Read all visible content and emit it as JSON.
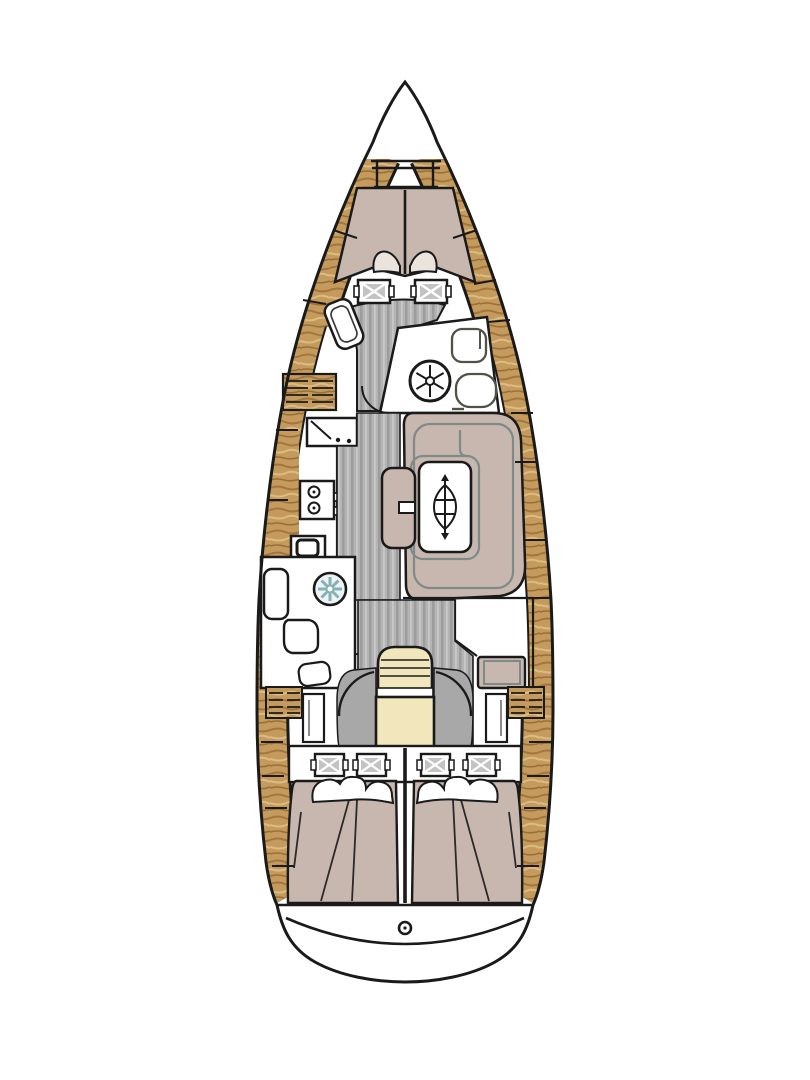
{
  "diagram": {
    "type": "sailboat-interior-floor-plan",
    "view": "top-down, bow at top / stern at bottom",
    "areas": [
      "anchor-locker",
      "v-berth-forward-cabin",
      "forward-cabin-seat",
      "forward-head-bathroom",
      "galley",
      "saloon-dinette",
      "saloon-table",
      "centerline-bench",
      "aft-head-bathroom",
      "chart-table-nav-station",
      "companionway-steps",
      "aft-cabin-port",
      "aft-cabin-starboard",
      "stern-swim-platform"
    ],
    "fixtures": [
      "windlass-frame",
      "berth-pillows",
      "hatch-seat-cushions",
      "sink-forward",
      "toilet-forward",
      "basin-forward",
      "fridge-top-load",
      "two-burner-stove",
      "oven",
      "sink-aft-teal",
      "toilet-aft",
      "table-extension-symbol",
      "louvered-lockers",
      "wardrobe-lockers",
      "rudder-post",
      "door-swing-arcs"
    ]
  },
  "colors": {
    "outline": "#1a1a1a",
    "hull_fill": "#ffffff",
    "wood": "#c49a5d",
    "wood_dark": "#a2763e",
    "wood_light": "#dcbc82",
    "berth": "#c8b7ae",
    "bedding": "#ebe4dd",
    "floor": "#b4b4b4",
    "floor_stripe_dark": "#9d9d9d",
    "floor_stripe_light": "#c7c7c7",
    "steps": "#f2e6bd",
    "door_panel": "#a8a8a8",
    "table_trim": "#7d8a88",
    "fixture_outline": "#4f5345",
    "sink_star": "#85b0b6",
    "cushion_gray": "#c3c3c3"
  }
}
